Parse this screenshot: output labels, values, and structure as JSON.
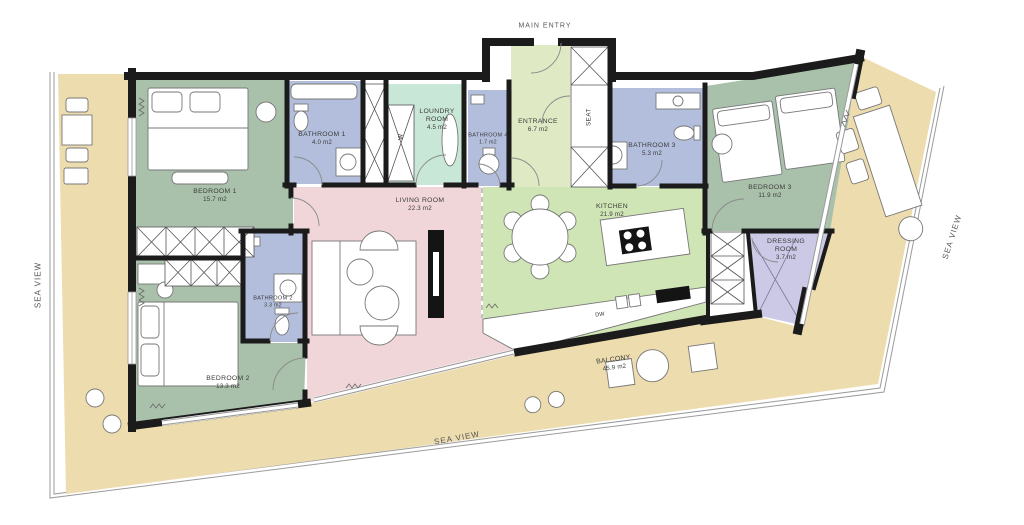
{
  "labels": {
    "main_entry": "MAIN ENTRY",
    "sea_view": "SEA VIEW",
    "seat": "SEAT",
    "dishwasher": "DW",
    "washer": "W"
  },
  "rooms": [
    {
      "id": "bedroom-1",
      "name": "BEDROOM 1",
      "area": "15.7 m2",
      "color": "#a9c1ab"
    },
    {
      "id": "bedroom-2",
      "name": "BEDROOM 2",
      "area": "13.3 m2",
      "color": "#a9c1ab"
    },
    {
      "id": "bedroom-3",
      "name": "BEDROOM 3",
      "area": "11.9 m2",
      "color": "#a9c1ab"
    },
    {
      "id": "bathroom-1",
      "name": "BATHROOM 1",
      "area": "4.0 m2",
      "color": "#b2bedc"
    },
    {
      "id": "bathroom-2",
      "name": "BATHROOM 2",
      "area": "3.3 m2",
      "color": "#b2bedc"
    },
    {
      "id": "bathroom-3",
      "name": "BATHROOM 3",
      "area": "5.3 m2",
      "color": "#b2bedc"
    },
    {
      "id": "bathroom-4",
      "name": "BATHROOM 4",
      "area": "1.7 m2",
      "color": "#b2bedc"
    },
    {
      "id": "loundry-room",
      "name": "LOUNDRY ROOM",
      "area": "4.5 m2",
      "color": "#c9e7d6"
    },
    {
      "id": "entrance",
      "name": "ENTRANCE",
      "area": "6.7 m2",
      "color": "#dfe9c4"
    },
    {
      "id": "living-room",
      "name": "LIVING ROOM",
      "area": "22.3 m2",
      "color": "#f1d6d9"
    },
    {
      "id": "kitchen",
      "name": "KITCHEN",
      "area": "21.9 m2",
      "color": "#cfe5b5"
    },
    {
      "id": "dressing-room",
      "name": "DRESSING ROOM",
      "area": "3.7 m2",
      "color": "#cbc9e5"
    },
    {
      "id": "balcony",
      "name": "BALCONY",
      "area": "45.9 m2",
      "color": "#eddcae"
    }
  ],
  "palette": {
    "wall": "#1b1b1b",
    "railing": "#9b9b9b",
    "background": "#ffffff"
  }
}
